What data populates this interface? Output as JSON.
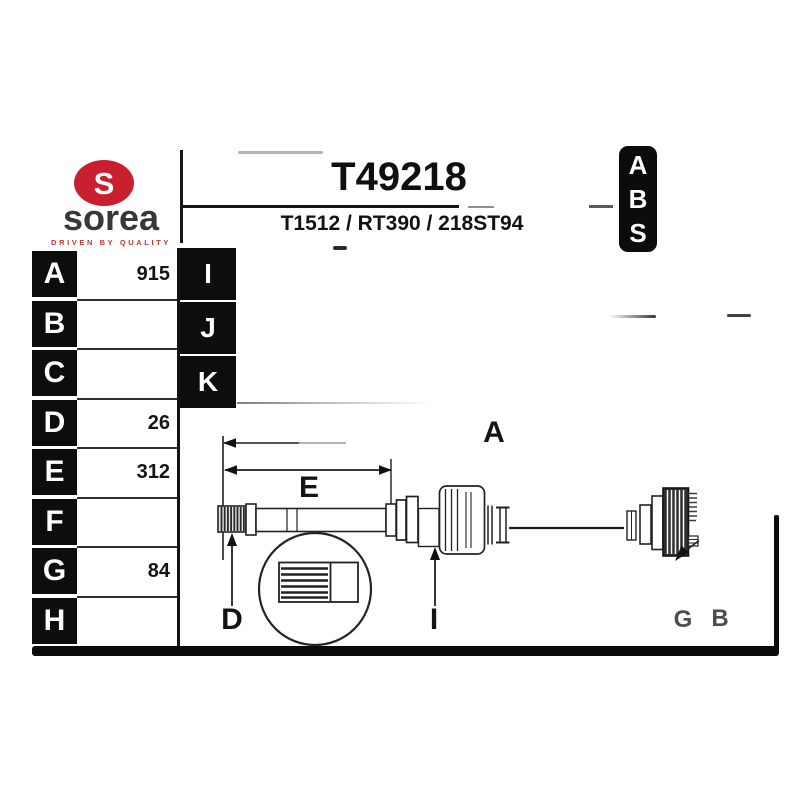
{
  "brand": {
    "name": "sorea",
    "tagline": "DRIVEN BY QUALITY",
    "logo_glyph": "S",
    "logo_red": "#c8202e"
  },
  "header": {
    "part_number": "T49218",
    "reference": "T1512 / RT390 / 218ST94"
  },
  "abs_badge": {
    "letters": [
      "A",
      "B",
      "S"
    ]
  },
  "spec_table": {
    "rows": [
      {
        "letter": "A",
        "value": "915"
      },
      {
        "letter": "B",
        "value": ""
      },
      {
        "letter": "C",
        "value": ""
      },
      {
        "letter": "D",
        "value": "26"
      },
      {
        "letter": "E",
        "value": "312"
      },
      {
        "letter": "F",
        "value": ""
      },
      {
        "letter": "G",
        "value": "84"
      },
      {
        "letter": "H",
        "value": ""
      }
    ]
  },
  "side_tabs": {
    "letters": [
      "I",
      "J",
      "K"
    ]
  },
  "diagram": {
    "labels": {
      "a": "A",
      "e": "E",
      "d": "D",
      "i": "I",
      "g": "G",
      "b": "B"
    }
  },
  "colors": {
    "tile_bg": "#0d0d0d",
    "tile_text": "#ffffff",
    "line": "#1f1f1f",
    "faded_label": "#4c4c4c"
  }
}
